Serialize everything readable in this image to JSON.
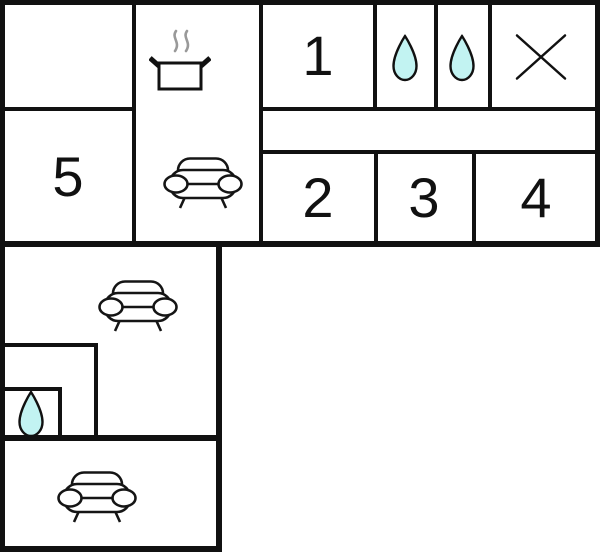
{
  "diagram": {
    "type": "floor-plan",
    "rooms": [
      {
        "label": "1"
      },
      {
        "label": "2"
      },
      {
        "label": "3"
      },
      {
        "label": "4"
      },
      {
        "label": "5"
      }
    ],
    "icons": [
      {
        "name": "cooking-pot-icon",
        "count": 1
      },
      {
        "name": "sofa-icon",
        "count": 3
      },
      {
        "name": "water-drop-icon",
        "count": 3
      },
      {
        "name": "cross-icon",
        "count": 1
      }
    ],
    "colors": {
      "wall": "#111111",
      "background": "#ffffff",
      "water_drop_fill": "#c2f3f2",
      "steam": "#999999"
    }
  }
}
